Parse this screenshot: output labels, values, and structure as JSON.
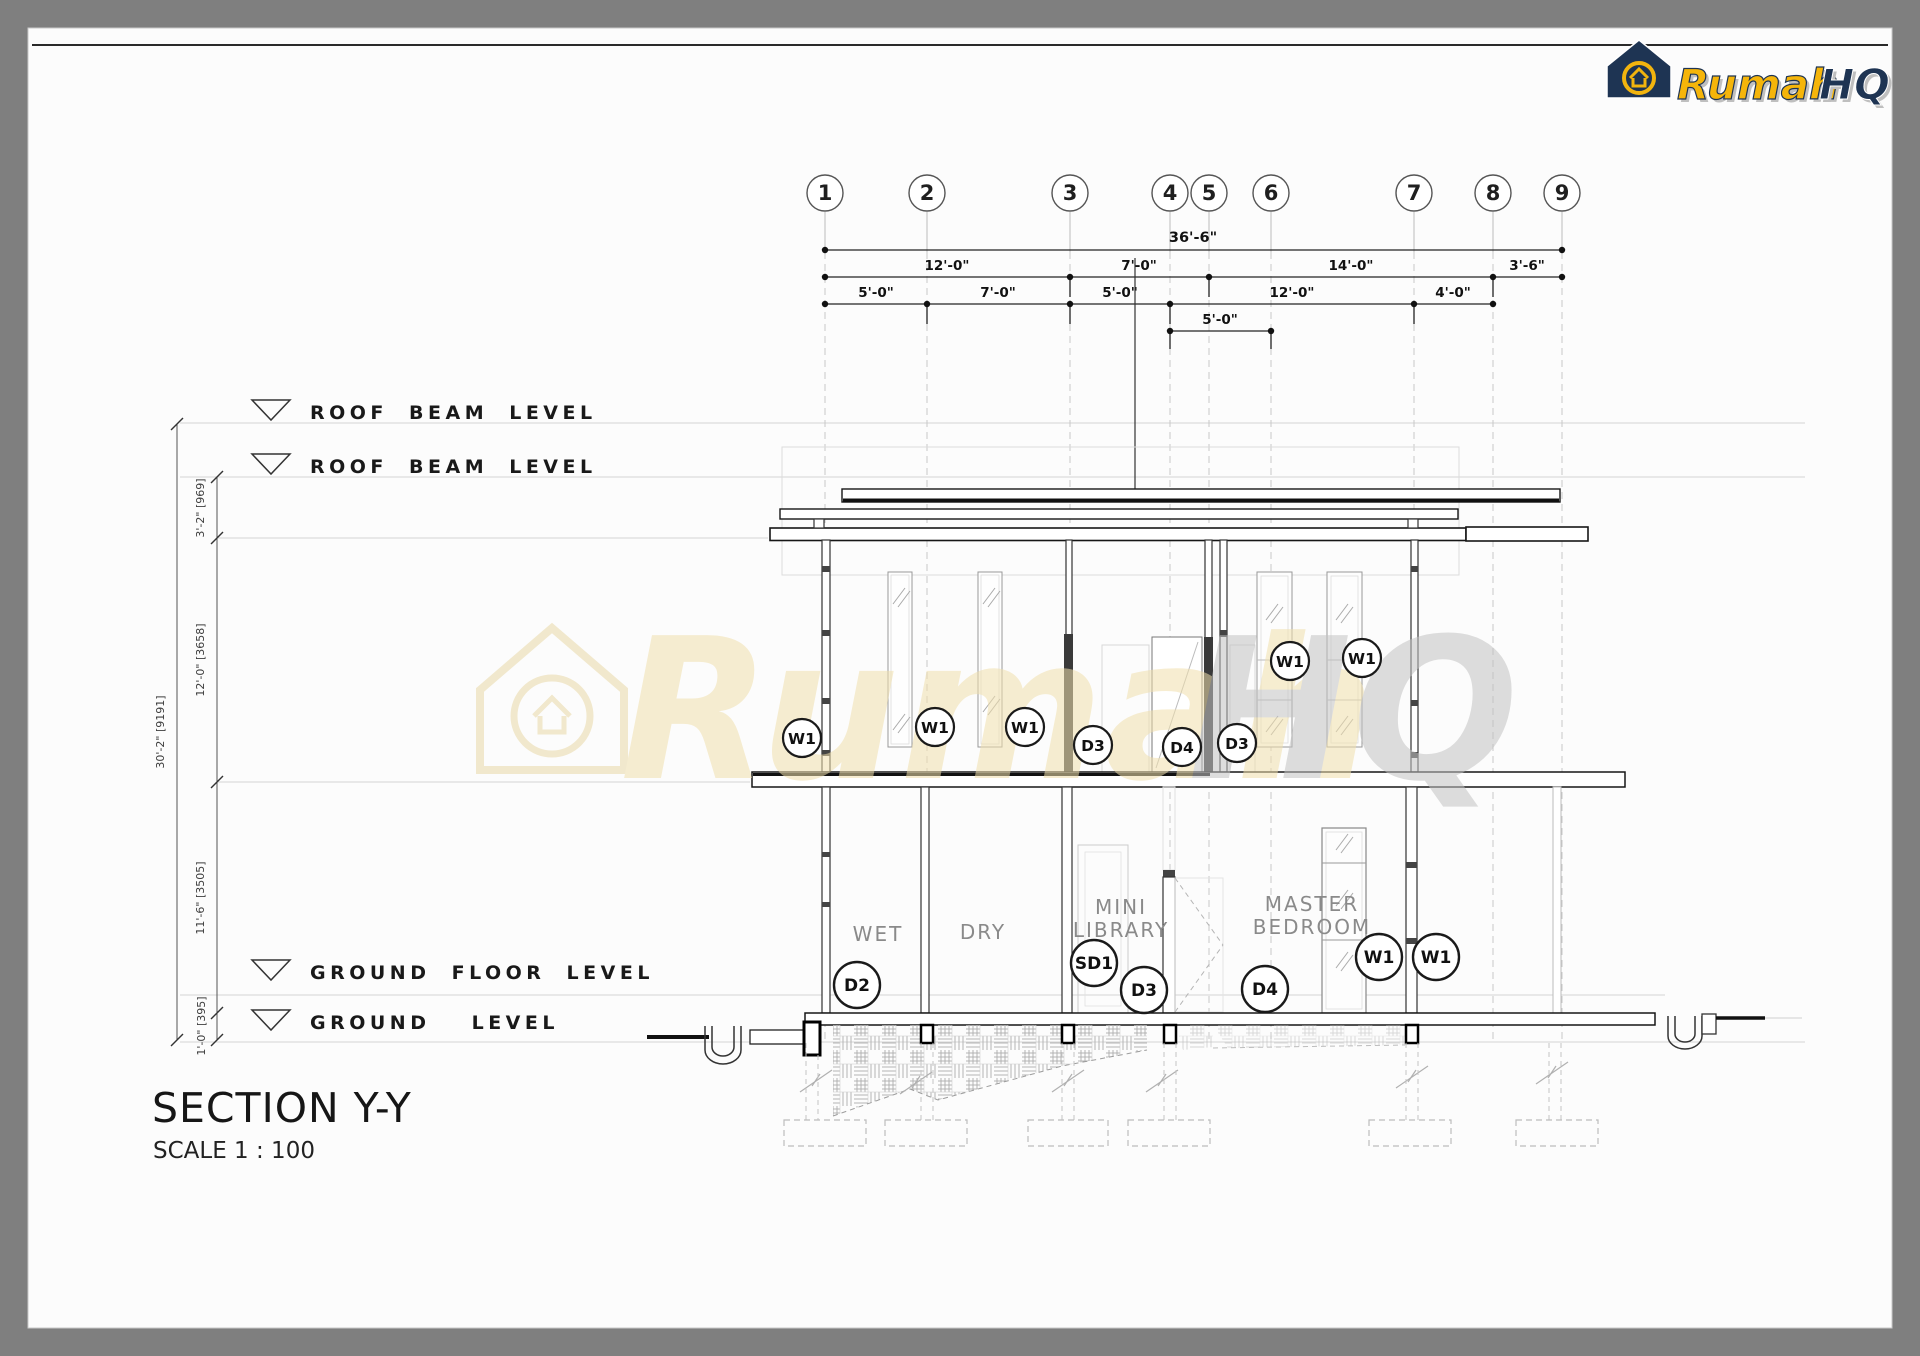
{
  "logo": {
    "brand_primary": "Rumah",
    "brand_secondary": "HQ",
    "gold": "#f2b40e",
    "navy": "#1e3453"
  },
  "grid": {
    "bubbles": [
      "1",
      "2",
      "3",
      "4",
      "5",
      "6",
      "7",
      "8",
      "9"
    ]
  },
  "dims_top": {
    "overall": "36'-6\"",
    "row2": [
      "12'-0\"",
      "7'-0\"",
      "14'-0\"",
      "3'-6\""
    ],
    "row3": [
      "5'-0\"",
      "7'-0\"",
      "5'-0\"",
      "12'-0\"",
      "4'-0\""
    ],
    "row4": "5'-0\""
  },
  "dims_left": {
    "overall": "30'-2\" [9191]",
    "segments": [
      "3'-2\" [969]",
      "12'-0\" [3658]",
      "11'-6\" [3505]",
      "1'-0\" [395]"
    ]
  },
  "levels": {
    "roof_beam_1": "ROOF BEAM LEVEL",
    "roof_beam_2": "ROOF BEAM LEVEL",
    "ground_floor": "GROUND FLOOR LEVEL",
    "ground": "GROUND LEVEL"
  },
  "rooms": {
    "wet": "WET",
    "dry": "DRY",
    "mini_library_1": "MINI",
    "mini_library_2": "LIBRARY",
    "master_bedroom_1": "MASTER",
    "master_bedroom_2": "BEDROOM"
  },
  "tags": {
    "upper": [
      "W1",
      "W1",
      "W1",
      "D3",
      "D4",
      "D3",
      "W1",
      "W1"
    ],
    "ground": [
      "D2",
      "SD1",
      "D3",
      "D4",
      "W1",
      "W1"
    ]
  },
  "watermark": {
    "primary": "Rumah",
    "secondary": "HQ"
  },
  "title": {
    "name": "SECTION Y-Y",
    "scale": "SCALE 1 : 100"
  }
}
